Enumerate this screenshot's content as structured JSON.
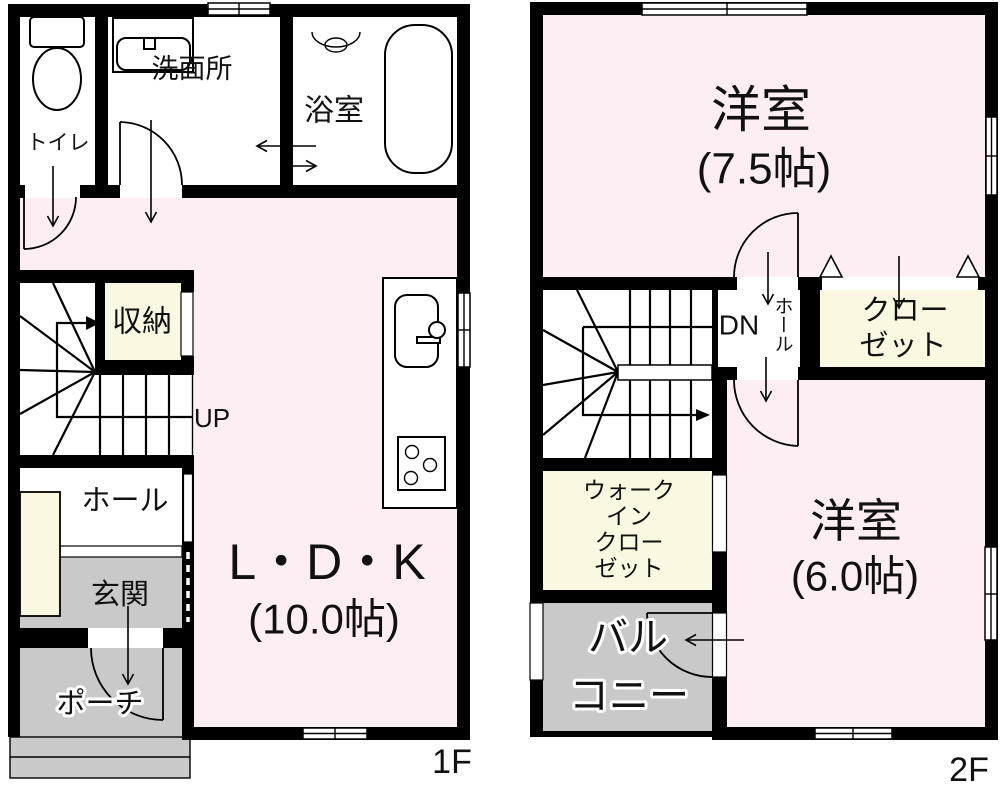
{
  "colors": {
    "room_pink": "#fdeef3",
    "closet_cream": "#faf8e1",
    "outdoor_gray": "#c9c9c9",
    "wall_black": "#000000"
  },
  "floor1": {
    "floor_label": "1F",
    "labels": {
      "toilet": "トイレ",
      "washroom": "洗面所",
      "bathroom": "浴室",
      "storage": "収納",
      "stairs": "UP",
      "hall": "ホール",
      "entrance": "玄関",
      "porch": "ポーチ",
      "ldk": "L・D・K",
      "ldk_size": "(10.0帖)"
    }
  },
  "floor2": {
    "floor_label": "2F",
    "labels": {
      "west_room_large": "洋室",
      "west_room_large_size": "(7.5帖)",
      "west_room_small": "洋室",
      "west_room_small_size": "(6.0帖)",
      "stairs": "DN",
      "hall": "ホール",
      "closet_line1": "クロー",
      "closet_line2": "ゼット",
      "wic_line1": "ウォーク",
      "wic_line2": "イン",
      "wic_line3": "クロー",
      "wic_line4": "ゼット",
      "balcony_line1": "バル",
      "balcony_line2": "コニー"
    }
  }
}
